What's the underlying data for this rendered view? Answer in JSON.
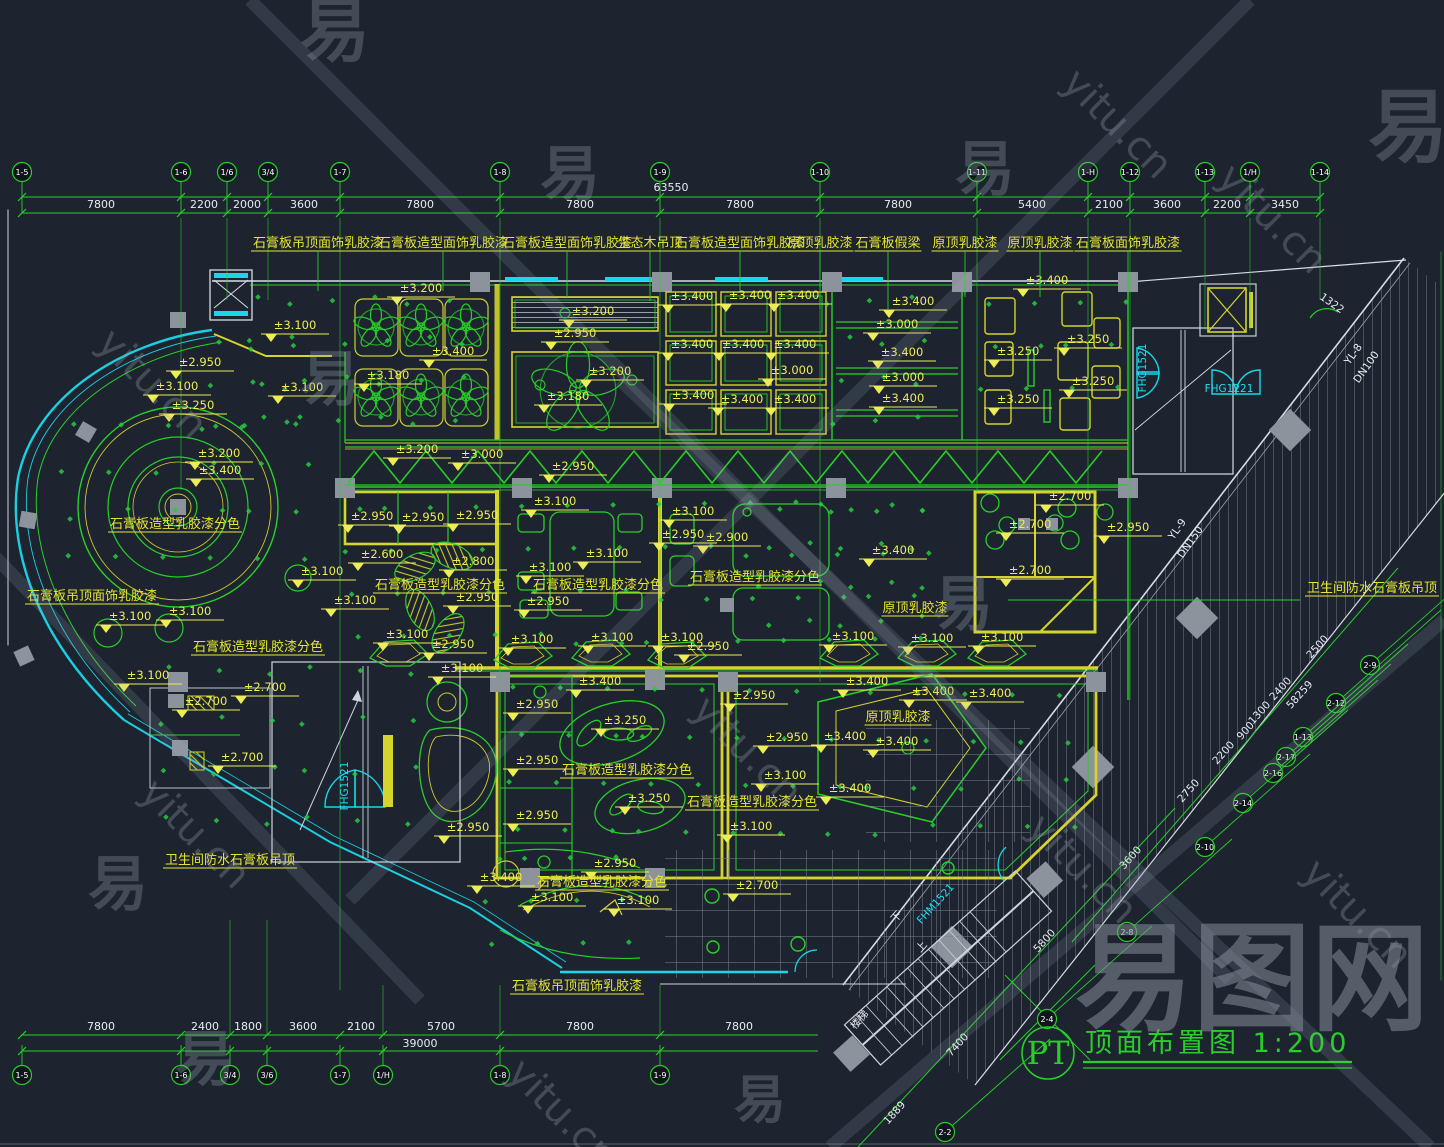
{
  "watermark": {
    "glyph": "易",
    "site": "yitu.cn",
    "brand": "易图网"
  },
  "title_block": {
    "tag": "PT",
    "title": "顶面布置图",
    "scale": "1:200"
  },
  "top_dim": {
    "total": "63550",
    "bubbles": [
      {
        "label": "1-5",
        "x": 22
      },
      {
        "label": "1-6",
        "x": 181
      },
      {
        "label": "1/6",
        "x": 227
      },
      {
        "label": "3/4",
        "x": 268
      },
      {
        "label": "1-7",
        "x": 340
      },
      {
        "label": "1-8",
        "x": 500
      },
      {
        "label": "1-9",
        "x": 660
      },
      {
        "label": "1-10",
        "x": 820
      },
      {
        "label": "1-11",
        "x": 977
      },
      {
        "label": "1-H",
        "x": 1088
      },
      {
        "label": "1-12",
        "x": 1130
      },
      {
        "label": "1-13",
        "x": 1205
      },
      {
        "label": "1/H",
        "x": 1250
      },
      {
        "label": "1-14",
        "x": 1320
      }
    ],
    "segments": [
      {
        "label": "7800",
        "x": 101
      },
      {
        "label": "2200",
        "x": 204
      },
      {
        "label": "2000",
        "x": 247
      },
      {
        "label": "3600",
        "x": 304
      },
      {
        "label": "7800",
        "x": 420
      },
      {
        "label": "7800",
        "x": 580
      },
      {
        "label": "7800",
        "x": 740
      },
      {
        "label": "7800",
        "x": 898
      },
      {
        "label": "5400",
        "x": 1032
      },
      {
        "label": "2100",
        "x": 1109
      },
      {
        "label": "3600",
        "x": 1167
      },
      {
        "label": "2200",
        "x": 1227
      },
      {
        "label": "3450",
        "x": 1285
      }
    ]
  },
  "bottom_dim": {
    "total": "39000",
    "bubbles": [
      {
        "label": "1-5",
        "x": 22
      },
      {
        "label": "1-6",
        "x": 181
      },
      {
        "label": "3/4",
        "x": 230
      },
      {
        "label": "3/6",
        "x": 267
      },
      {
        "label": "1-7",
        "x": 340
      },
      {
        "label": "1/H",
        "x": 383
      },
      {
        "label": "1-8",
        "x": 500
      },
      {
        "label": "1-9",
        "x": 660
      }
    ],
    "segments": [
      {
        "label": "7800",
        "x": 101
      },
      {
        "label": "2400",
        "x": 205
      },
      {
        "label": "1800",
        "x": 248
      },
      {
        "label": "3600",
        "x": 303
      },
      {
        "label": "2100",
        "x": 361
      },
      {
        "label": "5700",
        "x": 441
      },
      {
        "label": "7800",
        "x": 580
      },
      {
        "label": "7800",
        "x": 739
      }
    ]
  },
  "diagonal_dims": [
    {
      "v": "2500",
      "x": 1320,
      "y": 649
    },
    {
      "v": "2400",
      "x": 1283,
      "y": 691
    },
    {
      "v": "1300",
      "x": 1262,
      "y": 715
    },
    {
      "v": "900",
      "x": 1248,
      "y": 733
    },
    {
      "v": "2200",
      "x": 1226,
      "y": 755
    },
    {
      "v": "2750",
      "x": 1191,
      "y": 793
    },
    {
      "v": "58259",
      "x": 1302,
      "y": 697
    },
    {
      "v": "3600",
      "x": 1133,
      "y": 860
    },
    {
      "v": "5800",
      "x": 1047,
      "y": 943
    },
    {
      "v": "7400",
      "x": 960,
      "y": 1047
    },
    {
      "v": "1889",
      "x": 897,
      "y": 1115
    }
  ],
  "diagonal_bubbles": [
    {
      "label": "2-9",
      "x": 1370,
      "y": 665
    },
    {
      "label": "2-12",
      "x": 1336,
      "y": 703
    },
    {
      "label": "1-13",
      "x": 1303,
      "y": 737
    },
    {
      "label": "2-17",
      "x": 1286,
      "y": 757
    },
    {
      "label": "2-16",
      "x": 1273,
      "y": 773
    },
    {
      "label": "2-14",
      "x": 1243,
      "y": 803
    },
    {
      "label": "2-10",
      "x": 1205,
      "y": 847
    },
    {
      "label": "2-8",
      "x": 1127,
      "y": 932
    },
    {
      "label": "2-4",
      "x": 1047,
      "y": 1019
    },
    {
      "label": "2-2",
      "x": 945,
      "y": 1132
    }
  ],
  "levels": [
    [
      "±3.200",
      421,
      294
    ],
    [
      "±3.100",
      295,
      331
    ],
    [
      "±2.950",
      200,
      368
    ],
    [
      "±3.100",
      302,
      393
    ],
    [
      "±3.180",
      388,
      381
    ],
    [
      "±3.400",
      453,
      357
    ],
    [
      "±3.250",
      193,
      411
    ],
    [
      "±3.200",
      219,
      459
    ],
    [
      "±3.400",
      220,
      476
    ],
    [
      "±3.200",
      593,
      317
    ],
    [
      "±2.950",
      575,
      339
    ],
    [
      "±3.200",
      610,
      377
    ],
    [
      "±3.180",
      568,
      402
    ],
    [
      "±3.200",
      417,
      455
    ],
    [
      "±3.000",
      482,
      460
    ],
    [
      "±2.950",
      573,
      472
    ],
    [
      "±3.400",
      692,
      302
    ],
    [
      "±3.400",
      750,
      301
    ],
    [
      "±3.400",
      798,
      301
    ],
    [
      "±3.400",
      692,
      350
    ],
    [
      "±3.400",
      743,
      350
    ],
    [
      "±3.400",
      795,
      350
    ],
    [
      "±3.000",
      792,
      376
    ],
    [
      "±3.400",
      693,
      401
    ],
    [
      "±3.400",
      742,
      405
    ],
    [
      "±3.400",
      795,
      405
    ],
    [
      "±3.400",
      913,
      307
    ],
    [
      "±3.000",
      897,
      330
    ],
    [
      "±3.400",
      902,
      358
    ],
    [
      "±3.000",
      903,
      383
    ],
    [
      "±3.400",
      903,
      404
    ],
    [
      "±3.400",
      1047,
      286
    ],
    [
      "±3.250",
      1018,
      357
    ],
    [
      "±3.250",
      1088,
      345
    ],
    [
      "±3.250",
      1093,
      387
    ],
    [
      "±3.250",
      1018,
      405
    ],
    [
      "±3.100",
      177,
      392
    ],
    [
      "±3.100",
      322,
      577
    ],
    [
      "±3.100",
      130,
      622
    ],
    [
      "±3.100",
      190,
      617
    ],
    [
      "±2.950",
      372,
      522
    ],
    [
      "±2.950",
      423,
      523
    ],
    [
      "±2.950",
      477,
      521
    ],
    [
      "±3.100",
      555,
      507
    ],
    [
      "±2.600",
      382,
      560
    ],
    [
      "±2.800",
      473,
      567
    ],
    [
      "±3.100",
      607,
      559
    ],
    [
      "±3.100",
      550,
      573
    ],
    [
      "±3.100",
      355,
      606
    ],
    [
      "±2.950",
      477,
      603
    ],
    [
      "±2.950",
      548,
      607
    ],
    [
      "±3.100",
      693,
      517
    ],
    [
      "±2.950",
      683,
      540
    ],
    [
      "±2.900",
      727,
      543
    ],
    [
      "±3.100",
      407,
      640
    ],
    [
      "±2.950",
      453,
      650
    ],
    [
      "±3.100",
      532,
      645
    ],
    [
      "±3.100",
      612,
      643
    ],
    [
      "±3.100",
      682,
      643
    ],
    [
      "±2.950",
      708,
      652
    ],
    [
      "±2.700",
      1070,
      502
    ],
    [
      "±2.700",
      1030,
      530
    ],
    [
      "±2.950",
      1128,
      533
    ],
    [
      "±2.700",
      1030,
      576
    ],
    [
      "±3.400",
      893,
      556
    ],
    [
      "±3.100",
      853,
      642
    ],
    [
      "±3.100",
      932,
      644
    ],
    [
      "±3.100",
      1002,
      643
    ],
    [
      "±3.100",
      462,
      674
    ],
    [
      "±2.950",
      537,
      710
    ],
    [
      "±2.950",
      537,
      766
    ],
    [
      "±2.950",
      537,
      821
    ],
    [
      "±2.950",
      468,
      833
    ],
    [
      "±3.400",
      600,
      687
    ],
    [
      "±3.250",
      625,
      726
    ],
    [
      "±3.250",
      649,
      804
    ],
    [
      "±2.950",
      754,
      701
    ],
    [
      "±2.950",
      787,
      743
    ],
    [
      "±3.100",
      785,
      781
    ],
    [
      "±3.100",
      751,
      832
    ],
    [
      "±2.950",
      615,
      869
    ],
    [
      "±2.700",
      757,
      891
    ],
    [
      "±3.400",
      501,
      883
    ],
    [
      "±3.100",
      148,
      681
    ],
    [
      "±2.700",
      206,
      707
    ],
    [
      "±2.700",
      265,
      693
    ],
    [
      "±2.700",
      242,
      763
    ],
    [
      "±3.100",
      552,
      903
    ],
    [
      "±3.100",
      638,
      906
    ],
    [
      "±3.400",
      867,
      687
    ],
    [
      "±3.400",
      933,
      697
    ],
    [
      "±3.400",
      990,
      699
    ],
    [
      "±3.400",
      845,
      742
    ],
    [
      "±3.400",
      897,
      747
    ],
    [
      "±3.400",
      850,
      794
    ]
  ],
  "materials": [
    {
      "t": "石膏板吊顶面饰乳胶漆",
      "x": 318,
      "y": 247,
      "lead": 40
    },
    {
      "t": "石膏板造型面饰乳胶漆",
      "x": 443,
      "y": 247,
      "lead": 40
    },
    {
      "t": "石膏板造型面饰乳胶漆",
      "x": 567,
      "y": 247,
      "lead": 46
    },
    {
      "t": "生态木吊顶",
      "x": 650,
      "y": 247,
      "lead": 50
    },
    {
      "t": "石膏板造型面饰乳胶漆",
      "x": 740,
      "y": 247,
      "lead": 40
    },
    {
      "t": "原顶乳胶漆",
      "x": 820,
      "y": 247,
      "lead": 58
    },
    {
      "t": "石膏板假梁",
      "x": 888,
      "y": 247,
      "lead": 58
    },
    {
      "t": "原顶乳胶漆",
      "x": 965,
      "y": 247,
      "lead": 46
    },
    {
      "t": "原顶乳胶漆",
      "x": 1040,
      "y": 247,
      "lead": 46
    },
    {
      "t": "石膏板面饰乳胶漆",
      "x": 1128,
      "y": 247,
      "lead": 46
    },
    {
      "t": "石膏板造型乳胶漆分色",
      "x": 175,
      "y": 528,
      "lead": 0
    },
    {
      "t": "石膏板吊顶面饰乳胶漆",
      "x": 92,
      "y": 600,
      "lead": 0
    },
    {
      "t": "石膏板造型乳胶漆分色",
      "x": 258,
      "y": 651,
      "lead": 0
    },
    {
      "t": "石膏板造型乳胶漆分色",
      "x": 440,
      "y": 589,
      "lead": 0
    },
    {
      "t": "石膏板造型乳胶漆分色",
      "x": 598,
      "y": 589,
      "lead": 0
    },
    {
      "t": "石膏板造型乳胶漆分色",
      "x": 755,
      "y": 581,
      "lead": 0
    },
    {
      "t": "原顶乳胶漆",
      "x": 915,
      "y": 612,
      "lead": 0
    },
    {
      "t": "卫生间防水石膏板吊顶",
      "x": 1372,
      "y": 592,
      "lead": 0
    },
    {
      "t": "石膏板造型乳胶漆分色",
      "x": 627,
      "y": 774,
      "lead": 0
    },
    {
      "t": "石膏板造型乳胶漆分色",
      "x": 752,
      "y": 806,
      "lead": 0
    },
    {
      "t": "原顶乳胶漆",
      "x": 898,
      "y": 721,
      "lead": 0
    },
    {
      "t": "石膏板造型乳胶漆分色",
      "x": 602,
      "y": 886,
      "lead": 0
    },
    {
      "t": "卫生间防水石膏板吊顶",
      "x": 230,
      "y": 864,
      "lead": 0
    },
    {
      "t": "石膏板吊顶面饰乳胶漆",
      "x": 577,
      "y": 990,
      "lead": 0
    }
  ],
  "annotations": [
    {
      "t": "YL-8",
      "x": 1356,
      "y": 356,
      "rot": -55,
      "c": "white"
    },
    {
      "t": "DN100",
      "x": 1369,
      "y": 369,
      "rot": -55,
      "c": "white"
    },
    {
      "t": "YL-9",
      "x": 1180,
      "y": 531,
      "rot": -55,
      "c": "white"
    },
    {
      "t": "DN150",
      "x": 1193,
      "y": 544,
      "rot": -55,
      "c": "white"
    },
    {
      "t": "FHG1521",
      "x": 1146,
      "y": 368,
      "rot": -90,
      "c": "cyan"
    },
    {
      "t": "FHG1221",
      "x": 1229,
      "y": 392,
      "rot": 0,
      "c": "cyan"
    },
    {
      "t": "FHG1521",
      "x": 348,
      "y": 786,
      "rot": -90,
      "c": "cyan"
    },
    {
      "t": "FHM1521",
      "x": 938,
      "y": 906,
      "rot": -48,
      "c": "cyan"
    },
    {
      "t": "楼梯",
      "x": 862,
      "y": 1022,
      "rot": -48,
      "c": "white"
    },
    {
      "t": "下",
      "x": 899,
      "y": 919,
      "rot": -48,
      "c": "white"
    },
    {
      "t": "上",
      "x": 924,
      "y": 949,
      "rot": -48,
      "c": "white"
    },
    {
      "t": "1322",
      "x": 1330,
      "y": 306,
      "rot": 35,
      "c": "white"
    }
  ]
}
